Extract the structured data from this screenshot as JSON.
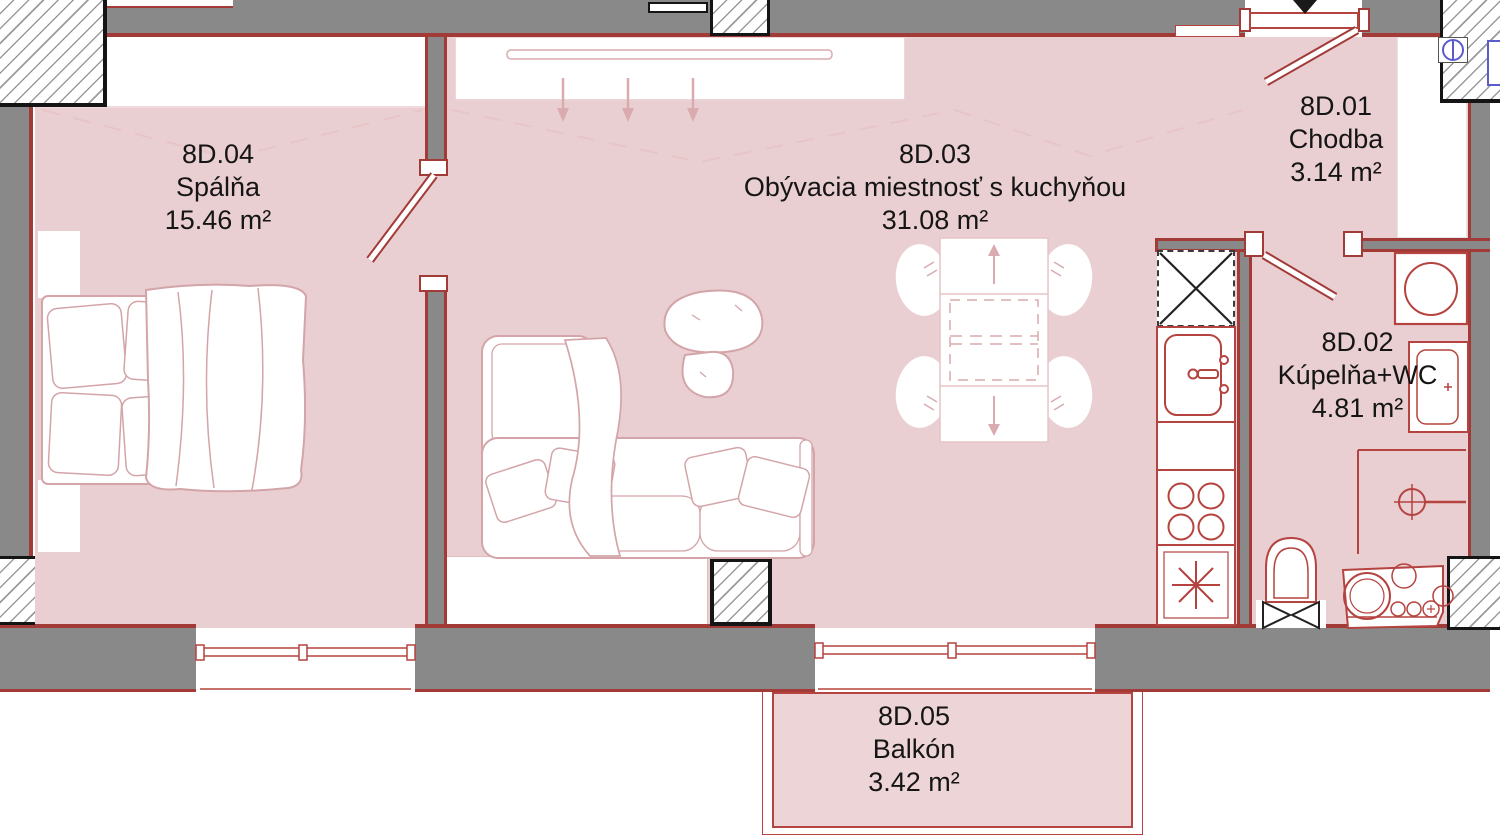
{
  "plan": {
    "title": "Apartment floor plan 8D",
    "rooms": [
      {
        "code": "8D.04",
        "name": "Spálňa",
        "area": "15.46 m²"
      },
      {
        "code": "8D.03",
        "name": "Obývacia miestnosť s kuchyňou",
        "area": "31.08 m²"
      },
      {
        "code": "8D.01",
        "name": "Chodba",
        "area": "3.14 m²"
      },
      {
        "code": "8D.02",
        "name": "Kúpelňa+WC",
        "area": "4.81 m²"
      },
      {
        "code": "8D.05",
        "name": "Balkón",
        "area": "3.42 m²"
      }
    ],
    "colors": {
      "floor_pink": "#eacfd2",
      "wall_gray": "#898989",
      "wall_edge_red": "#a23b38",
      "fixture_red": "#b5433f",
      "furniture_sketch_pink": "#d3a4a8",
      "intercom_blue": "#5b5bce",
      "label_text": "#151515"
    },
    "fixtures": [
      "bed",
      "nightstand",
      "wardrobe",
      "sofa",
      "plant",
      "dining-table",
      "chair",
      "tv-sideboard",
      "shaft",
      "kitchen-sink",
      "cooktop",
      "dishwasher",
      "washing-machine",
      "washbasin",
      "shower-drain",
      "toilet",
      "bathroom-cabinet",
      "entrance-arrow",
      "intercom"
    ]
  }
}
